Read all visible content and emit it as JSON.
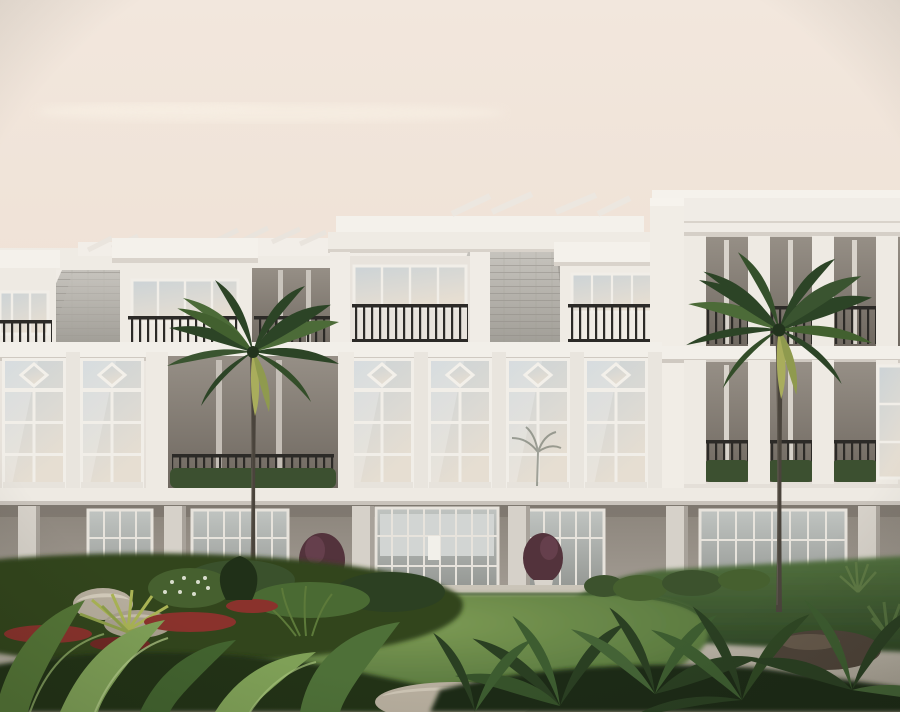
{
  "scene": {
    "type": "architectural-rendering",
    "alt_text": "Exterior rendering of a white three-story coastal condominium building with gray slate mansard roofs, dormer balconies with black railings, tall divided-light windows with diamond transom motifs, open roof terraces, a recessed ground-floor loggia with glass doors, two tall palm trees, an oval green lawn, curved light paths, boulders, red flower beds and tropical foliage in the foreground under a hazy pink-beige sky."
  },
  "building": {
    "stories_visible": 3,
    "roof": "gray slate mansard with dormer balconies and parapet crests",
    "window_style": "divided-light windows with diamond transoms",
    "ground_floor": "recessed loggia with square columns and glass doors",
    "balcony_railing": "black metal vertical bars",
    "planters": "green hedge boxes on terrace edges"
  },
  "landscape": {
    "palm_trees": 2,
    "lawn": "large oval lawn",
    "paths": "light curved walkways",
    "flower_beds": "red flowering groundcover with light boulders",
    "foreground": "large tropical leaves and ferns with rocks"
  },
  "palette": {
    "sky_top": "#f2e7dd",
    "sky_mid": "#eee0d4",
    "sky_bottom": "#e9d8cb",
    "cloud": "#f8f0e4",
    "wall_light": "#f1ede7",
    "wall": "#ded8d0",
    "cornice": "#f5f2ec",
    "roof_slate_light": "#c6c3bd",
    "roof_slate": "#a09d96",
    "recess_bay_top": "#968f86",
    "recess_bay_bottom": "#6f6860",
    "glass_top": "#ccd3d6",
    "glass_warm": "#e6ded2",
    "railing": "#2c2a27",
    "hedge": "#3c5030",
    "hedge_dark": "#2b3b22",
    "ground_wall_top": "#8b847b",
    "ground_wall": "#a59e95",
    "column": "#d6d1c9",
    "door_glass": "#c0c4c1",
    "pot_plant": "#53333c",
    "pot": "#d9d4cc",
    "path_light": "#cbc5b9",
    "path_dark": "#a29a8d",
    "lawn_light": "#7d9b55",
    "lawn": "#5d7c41",
    "lawn_dark": "#3f5c2e",
    "bank_light": "#52703e",
    "bank_dark": "#2f4726",
    "bed_dark": "#273821",
    "flower_red": "#8a322c",
    "palmetto": "#aab455",
    "rock_light": "#b7ae9e",
    "rock_dark": "#4e4339",
    "palm_frond": "#2c4426",
    "palm_frond_light": "#4c6b38",
    "palm_frond_yellow": "#a9ad5c",
    "trunk": "#4a443c",
    "foliage_light": "#7fa057",
    "foliage": "#4e7038",
    "foliage_dark": "#2a3f22"
  }
}
